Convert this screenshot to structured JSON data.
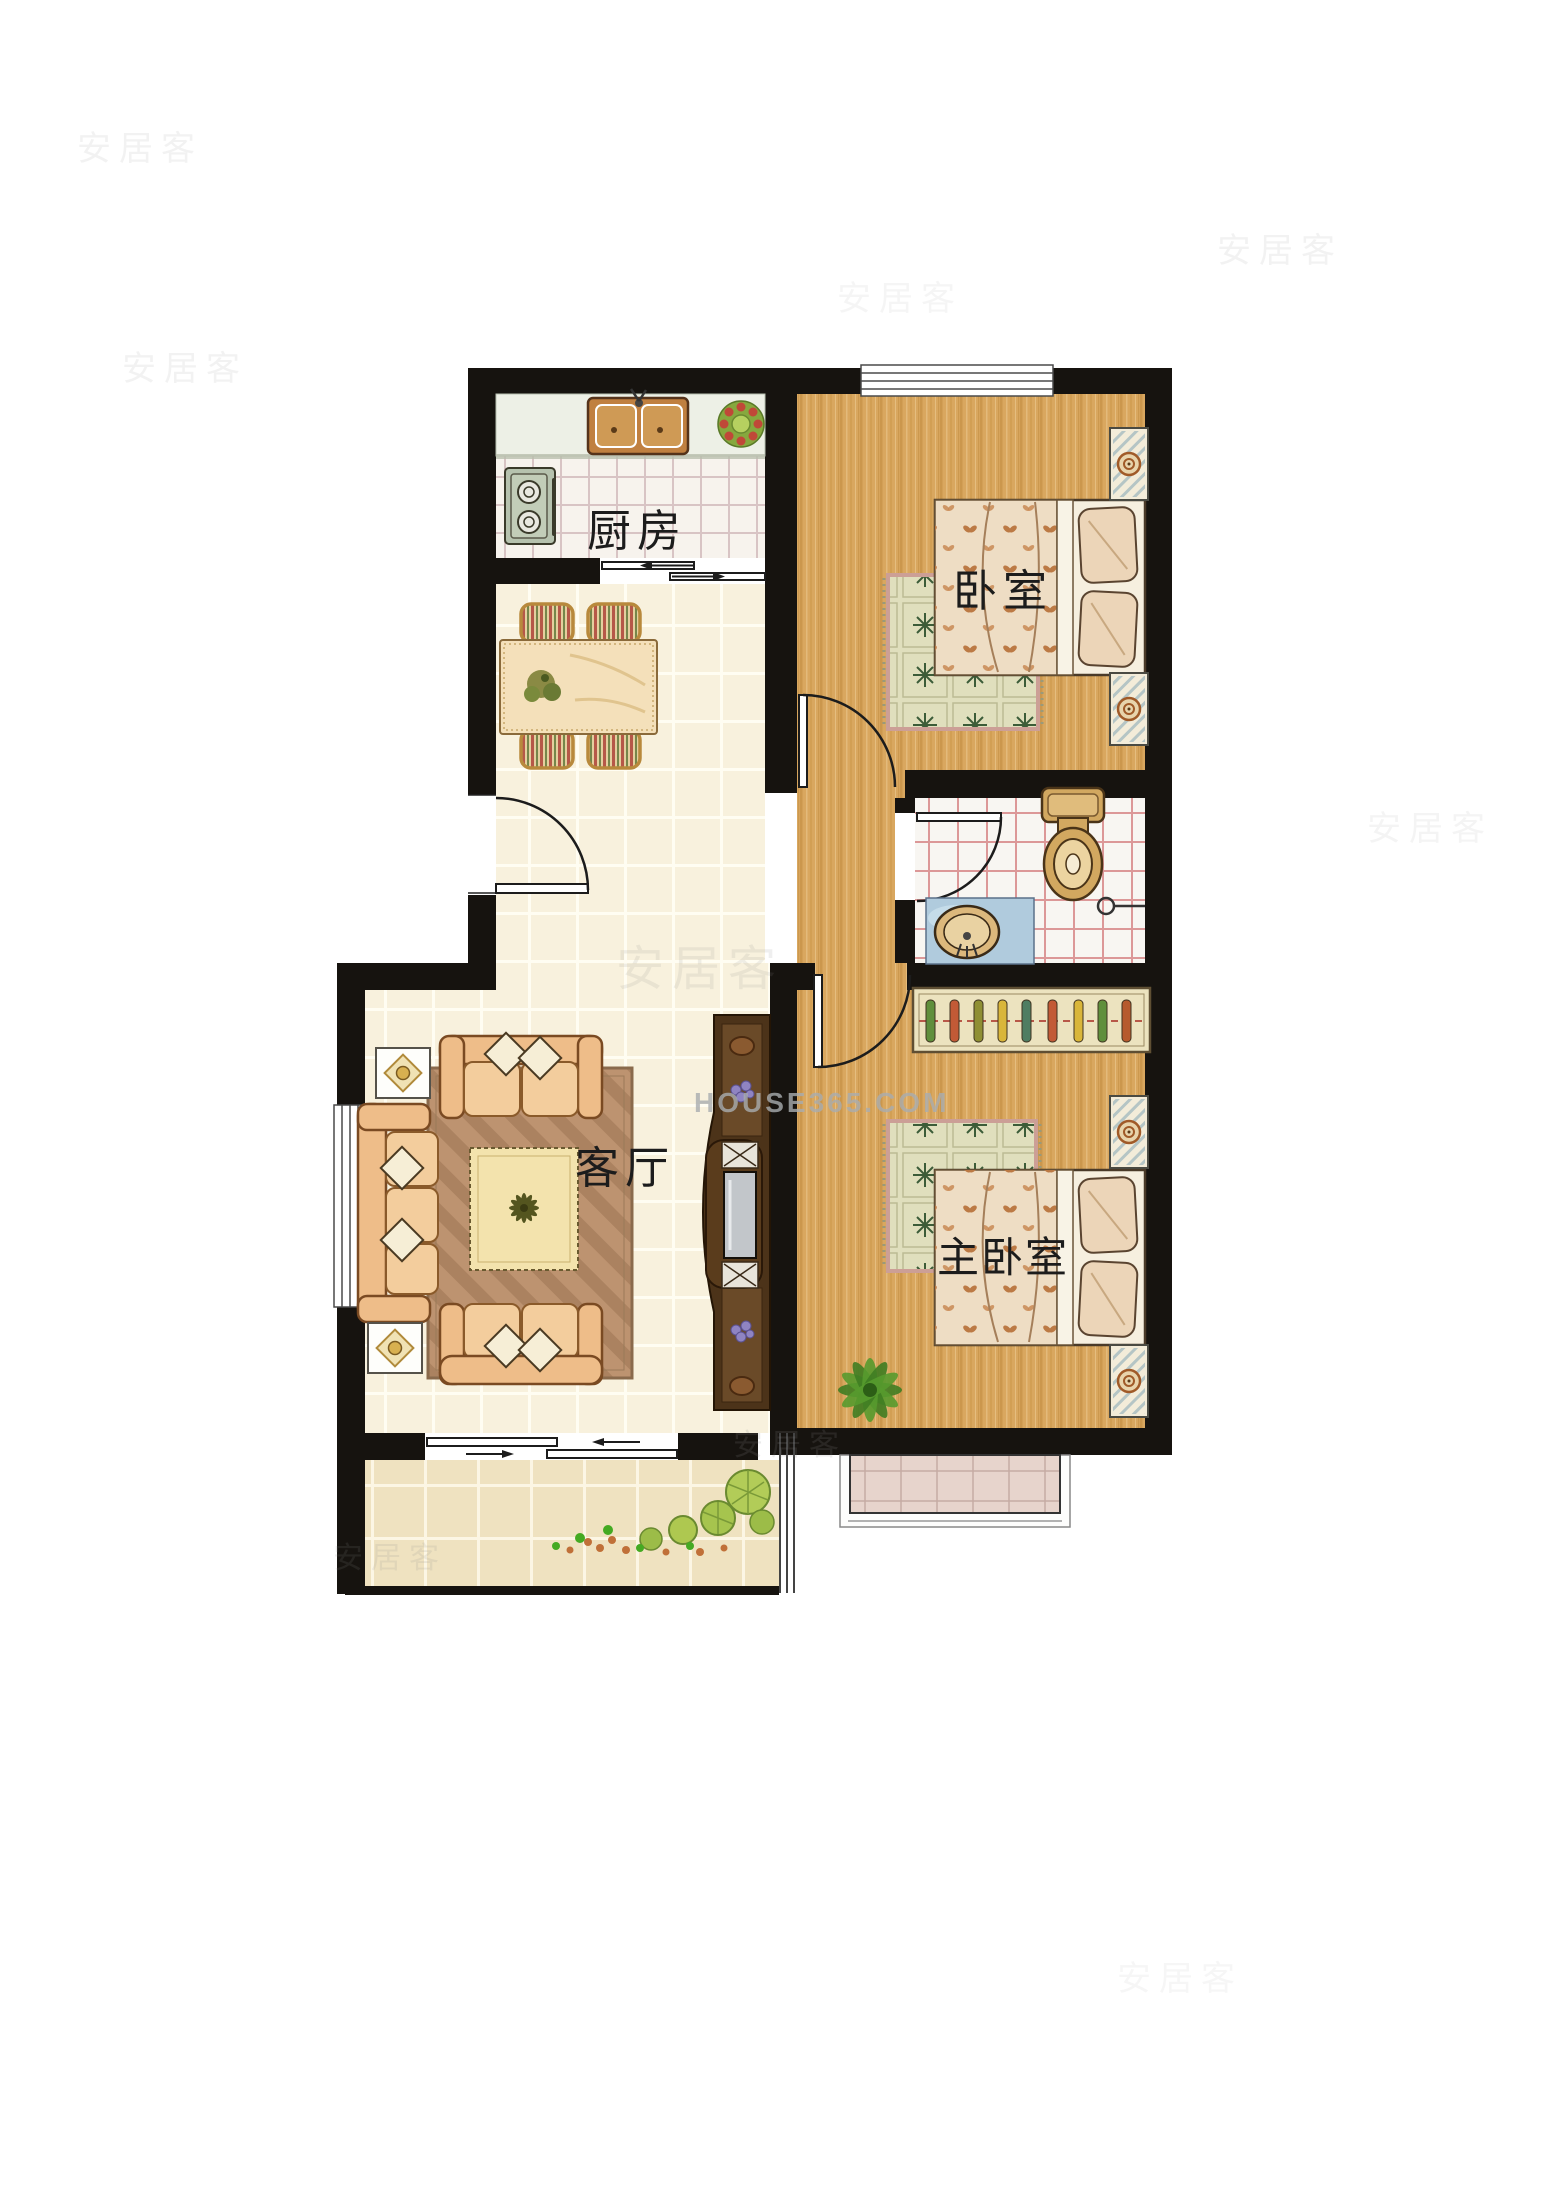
{
  "page": {
    "title": "两室一厅户型图",
    "background": "#ffffff"
  },
  "watermarks": {
    "site": "HOUSE365.COM",
    "brand": "安居客"
  },
  "rooms": {
    "kitchen": {
      "label": "厨房",
      "furniture": [
        "double-sink",
        "stove",
        "potted-plant",
        "counter"
      ]
    },
    "bedroom": {
      "label": "卧室",
      "furniture": [
        "double-bed",
        "nightstand",
        "nightstand",
        "rug",
        "window"
      ]
    },
    "living_room": {
      "label": "客厅",
      "furniture": [
        "sofa-set",
        "coffee-table",
        "rug",
        "tv-cabinet",
        "side-table-lamps",
        "window"
      ]
    },
    "master_bedroom": {
      "label": "主卧室",
      "furniture": [
        "double-bed",
        "wardrobe",
        "nightstand",
        "nightstand",
        "rug",
        "plant",
        "bay-window"
      ]
    },
    "bathroom": {
      "label": "",
      "furniture": [
        "toilet",
        "sink-vanity",
        "floor-drain"
      ]
    },
    "dining": {
      "label": "",
      "furniture": [
        "dining-table",
        "chairs-4"
      ]
    },
    "balcony": {
      "label": "",
      "furniture": [
        "shrubs",
        "sliding-door"
      ]
    }
  },
  "colors": {
    "wall": "#16130f",
    "wood-floor": "#d9a75f",
    "cream-tile": "#f8f1dd",
    "kitchen-tile": "#f7f3ed",
    "bath-tile": "#f8f6f2",
    "balcony-tile": "#efe2c0",
    "sofa": "#eebd89",
    "rug-living": "#bd9370",
    "watermark-gray": "#a9adb0"
  }
}
